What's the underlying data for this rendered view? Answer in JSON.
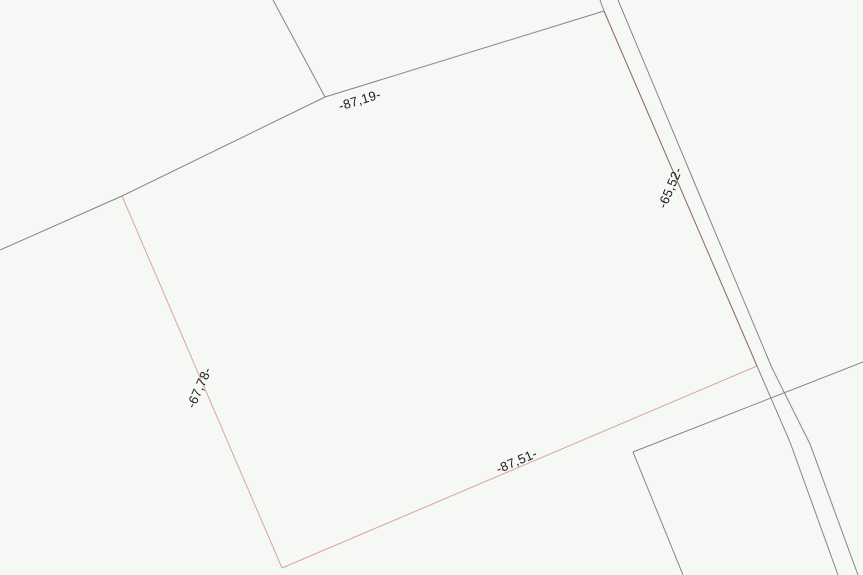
{
  "map": {
    "width": 863,
    "height": 575,
    "background_color": "#f5f8f5",
    "colors": {
      "gray": "#858585",
      "pink": "#dba2a2",
      "maroon": "#8d6363",
      "text": "#1d1d1d"
    },
    "dimension_labels": [
      {
        "id": "north",
        "text": "-87,19-",
        "x": 360,
        "y": 101,
        "rotation": -17
      },
      {
        "id": "east",
        "text": "-65,52-",
        "x": 671,
        "y": 188,
        "rotation": -67
      },
      {
        "id": "south",
        "text": "-87,51-",
        "x": 517,
        "y": 462,
        "rotation": -23
      },
      {
        "id": "west",
        "text": "-67,78-",
        "x": 200,
        "y": 388,
        "rotation": -66
      }
    ],
    "lines": [
      {
        "id": "neighbor-boundary-northwest-and-parcel-north-edge",
        "color": "gray",
        "points": [
          [
            0,
            250
          ],
          [
            122,
            196
          ],
          [
            325,
            97
          ],
          [
            604,
            11
          ]
        ]
      },
      {
        "id": "neighbor-line-top",
        "color": "gray",
        "points": [
          [
            273,
            0
          ],
          [
            325,
            97
          ]
        ]
      },
      {
        "id": "parcel-west-edge",
        "color": "pink",
        "points": [
          [
            122,
            196
          ],
          [
            282,
            568
          ]
        ]
      },
      {
        "id": "parcel-south-edge",
        "color": "pink",
        "points": [
          [
            282,
            568
          ],
          [
            757,
            366
          ]
        ]
      },
      {
        "id": "parcel-east-edge-on-road",
        "color": "maroon",
        "points": [
          [
            604,
            11
          ],
          [
            757,
            366
          ]
        ]
      },
      {
        "id": "road-left-line-upper-stub",
        "color": "gray",
        "points": [
          [
            600,
            0
          ],
          [
            604,
            11
          ]
        ]
      },
      {
        "id": "road-left-line-lower",
        "color": "gray",
        "points": [
          [
            757,
            366
          ],
          [
            790,
            442
          ],
          [
            838,
            575
          ]
        ]
      },
      {
        "id": "road-right-line",
        "color": "gray",
        "points": [
          [
            618,
            0
          ],
          [
            700,
            196
          ],
          [
            772,
            368
          ],
          [
            810,
            444
          ],
          [
            858,
            575
          ]
        ]
      },
      {
        "id": "neighbor-crossing-line-southeast",
        "color": "gray",
        "points": [
          [
            633,
            452
          ],
          [
            863,
            362
          ]
        ]
      },
      {
        "id": "neighbor-edge-south",
        "color": "gray",
        "points": [
          [
            633,
            452
          ],
          [
            683,
            575
          ]
        ]
      }
    ]
  }
}
